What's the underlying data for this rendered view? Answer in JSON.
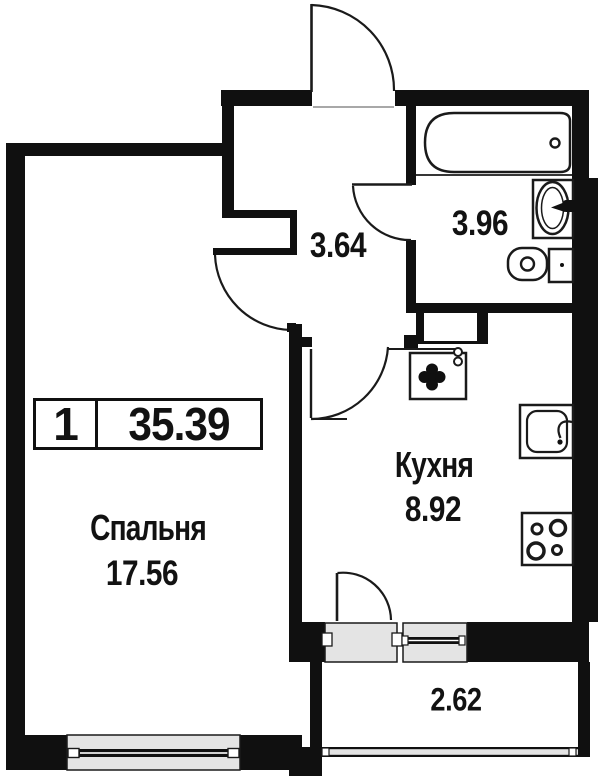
{
  "apartment_plan": {
    "badge": {
      "rooms_count": "1",
      "total_area": "35.39"
    },
    "rooms": {
      "bedroom": {
        "label": "Спальня",
        "area": "17.56"
      },
      "kitchen": {
        "label": "Кухня",
        "area": "8.92"
      },
      "hallway": {
        "area": "3.64"
      },
      "bathroom": {
        "area": "3.96"
      },
      "balcony": {
        "area": "2.62"
      }
    },
    "colors": {
      "wall": "#101010",
      "line": "#1a1a1a",
      "glazing_fill": "#e4e4e4",
      "background": "#ffffff",
      "text": "#121212"
    },
    "fixtures": [
      "bathtub",
      "bathroom-sink",
      "toilet",
      "washing-machine",
      "vent-shaft",
      "kitchen-sink",
      "stove"
    ],
    "doors": [
      "entrance",
      "bedroom",
      "bathroom",
      "kitchen",
      "balcony"
    ],
    "windows": [
      "bedroom-window",
      "balcony-window",
      "balcony-railing"
    ]
  }
}
